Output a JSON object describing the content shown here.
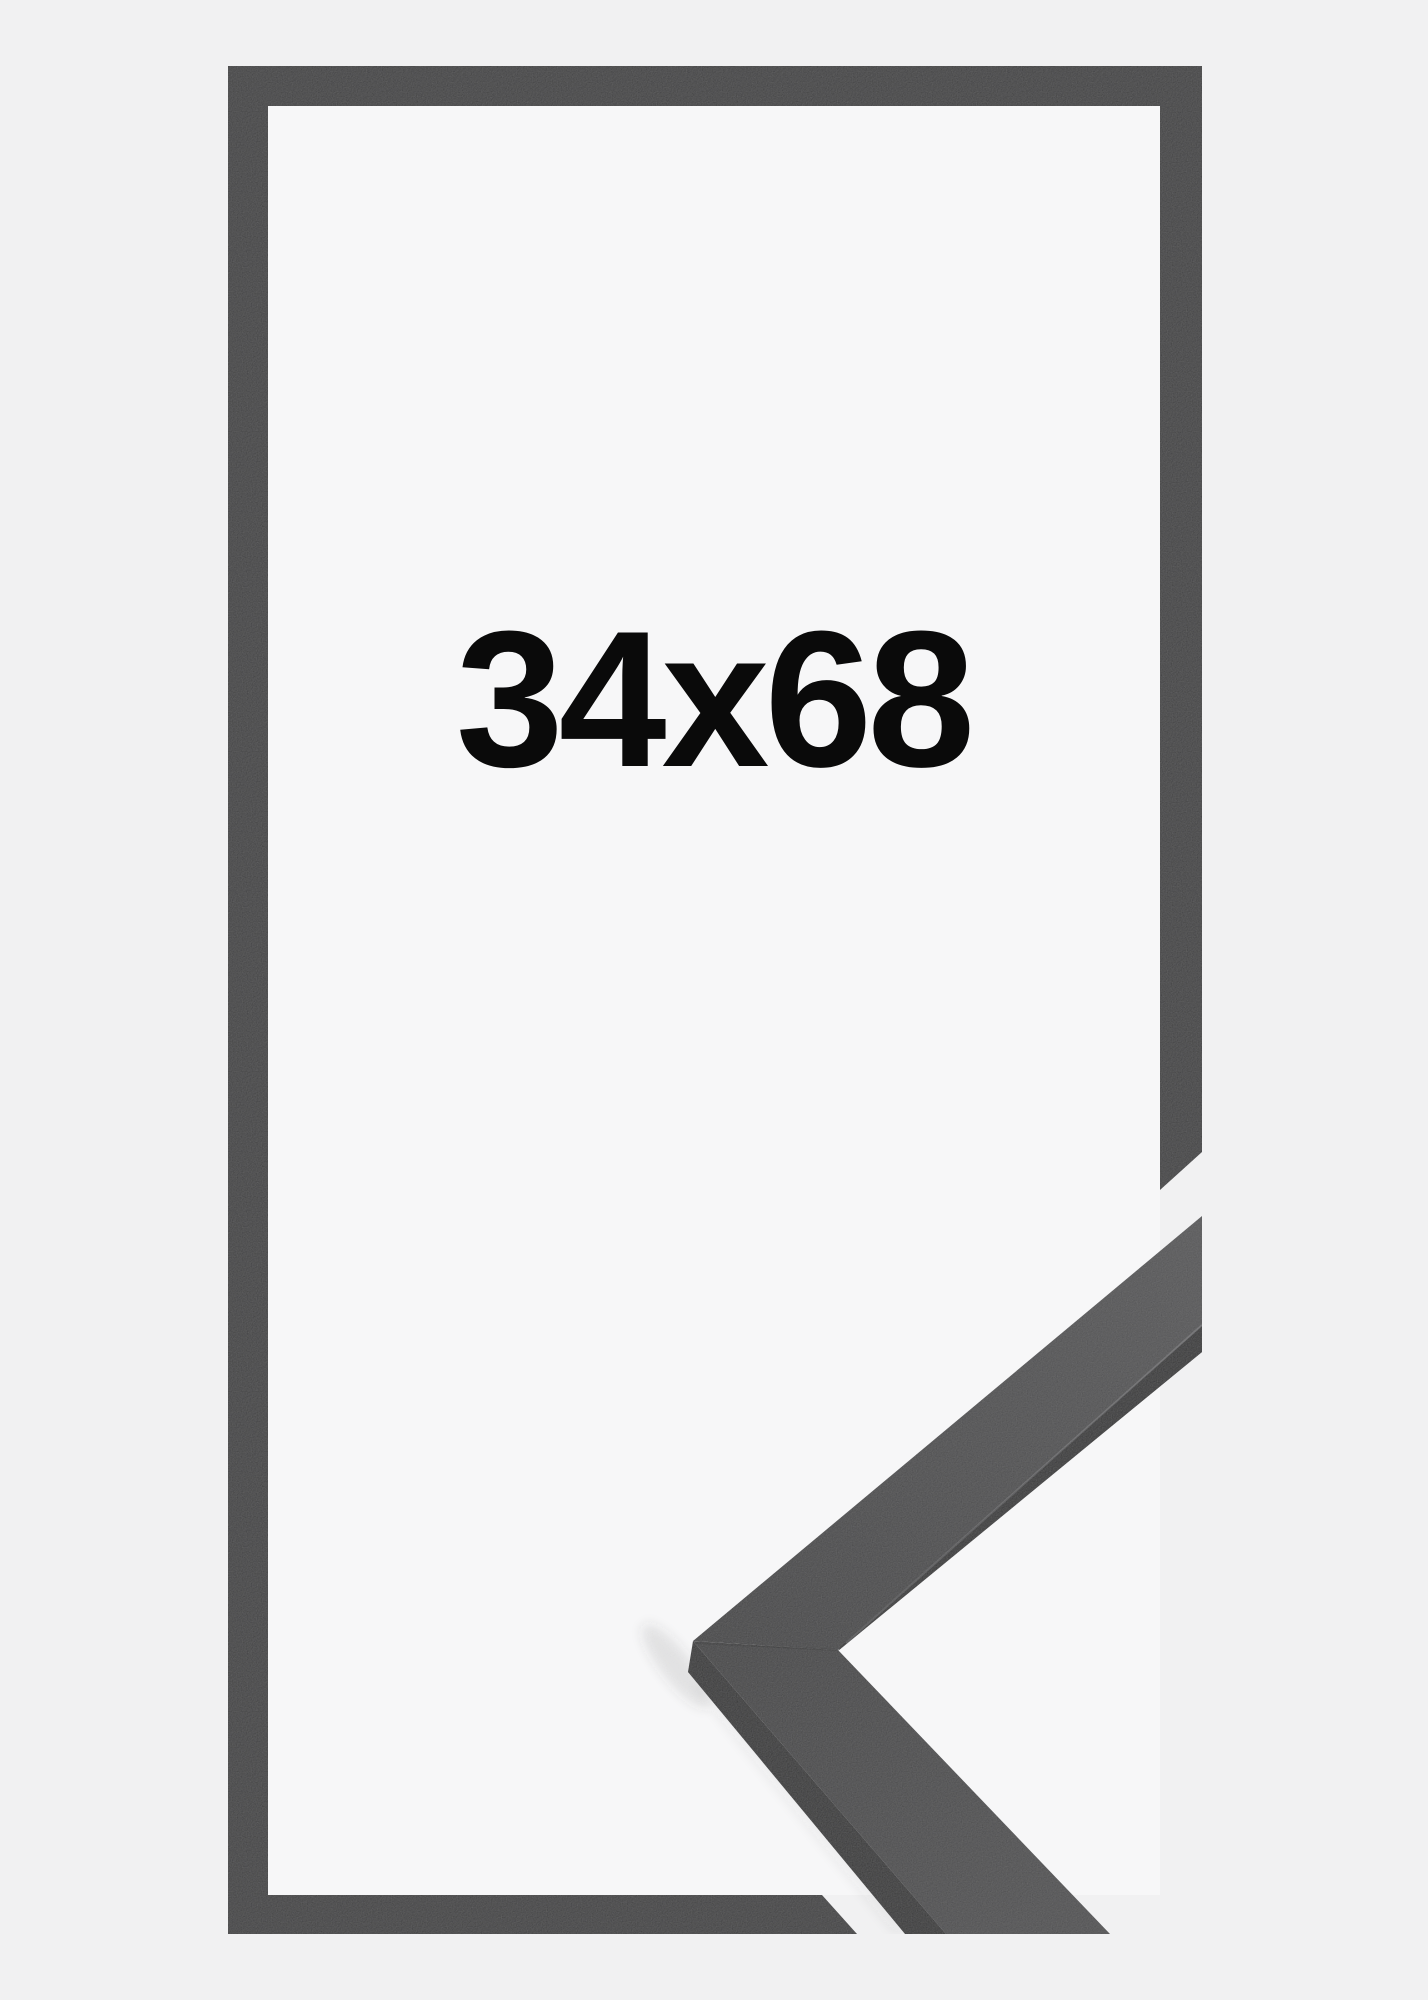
{
  "product_image": {
    "size_label": "34x68"
  },
  "colors": {
    "background": "#f1f1f2",
    "frame_interior": "#f7f7f8",
    "frame_outline": "#2d2d2f",
    "label_text": "#0a0a0a",
    "molding_face_light": "#4a4a4c",
    "molding_face_dark": "#323234",
    "molding_face_bottom": "#414143",
    "molding_edge": "#1b1b1d"
  }
}
